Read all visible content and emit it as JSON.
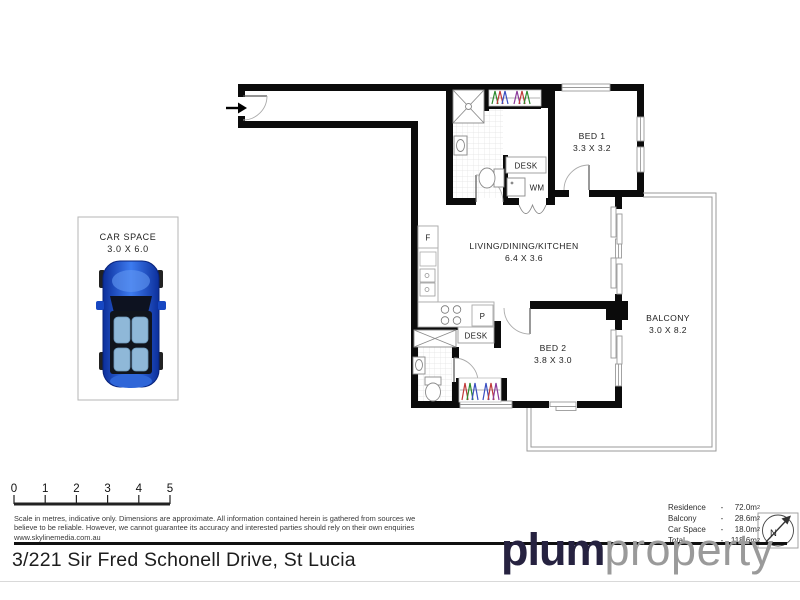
{
  "address": "3/221 Sir Fred Schonell Drive, St Lucia",
  "logo": {
    "bold": "plum",
    "light": "property"
  },
  "compass": {
    "label": "N"
  },
  "scale_bar": {
    "ticks": [
      "0",
      "1",
      "2",
      "3",
      "4",
      "5"
    ]
  },
  "disclaimer": {
    "line1": "Scale in metres, indicative only. Dimensions are approximate. All information contained herein is gathered from sources we",
    "line2": "believe to be reliable. However, we cannot guarantee its accuracy and interested parties should rely on their own enquiries",
    "line3": "www.skylinemedia.com.au"
  },
  "areas": {
    "rows": [
      {
        "label": "Residence",
        "dash": "-",
        "value": "72.0m",
        "sup": "2"
      },
      {
        "label": "Balcony",
        "dash": "-",
        "value": "28.6m",
        "sup": "2"
      },
      {
        "label": "Car Space",
        "dash": "-",
        "value": "18.0m",
        "sup": "2"
      },
      {
        "label": "Total",
        "dash": "-",
        "value": "118.6m",
        "sup": "2"
      }
    ]
  },
  "car_space": {
    "name": "CAR SPACE",
    "dims": "3.0 X 6.0"
  },
  "rooms": {
    "bed1": {
      "name": "BED 1",
      "dims": "3.3 X 3.2"
    },
    "bed2": {
      "name": "BED 2",
      "dims": "3.8 X 3.0"
    },
    "living": {
      "name": "LIVING/DINING/KITCHEN",
      "dims": "6.4 X 3.6"
    },
    "balcony": {
      "name": "BALCONY",
      "dims": "3.0 X 8.2"
    }
  },
  "fixtures": {
    "desk1": "DESK",
    "desk2": "DESK",
    "wm": "WM",
    "fridge": "F",
    "pantry": "P"
  },
  "colors": {
    "wall": "#0b0b0b",
    "car_blue": "#1747c2",
    "logo_navy": "#262240"
  }
}
